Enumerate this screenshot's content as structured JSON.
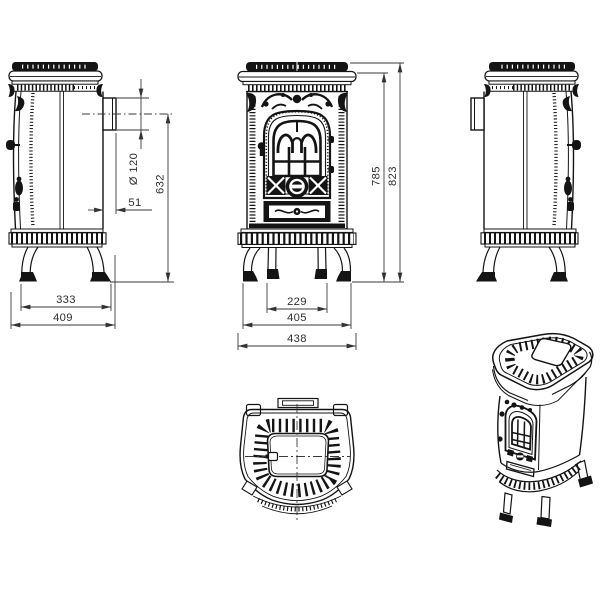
{
  "drawing": {
    "background": "#ffffff",
    "line_color": "#141414",
    "dimension_color": "#3a3a3a",
    "views": {
      "side": {
        "dims": {
          "flue_diameter": "Ø 120",
          "flue_center_height": "632",
          "flue_offset": "51",
          "feet_span": "333",
          "overall_depth": "409"
        }
      },
      "front": {
        "dims": {
          "body_height": "785",
          "overall_height": "823",
          "inner_feet_span": "229",
          "outer_feet_span": "405",
          "overall_width": "438"
        }
      }
    }
  }
}
